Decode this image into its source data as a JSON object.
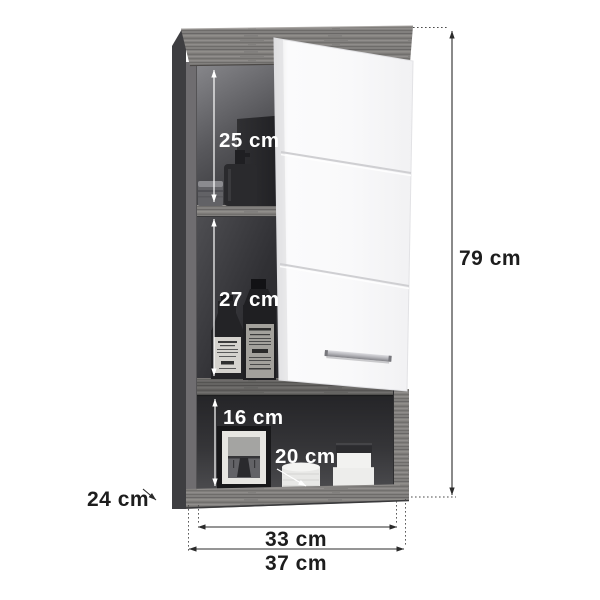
{
  "dimensions": {
    "total_height": {
      "value": 79,
      "unit": "cm",
      "label": "79 cm"
    },
    "total_width": {
      "value": 37,
      "unit": "cm",
      "label": "37 cm"
    },
    "inner_width": {
      "value": 33,
      "unit": "cm",
      "label": "33 cm"
    },
    "depth": {
      "value": 24,
      "unit": "cm",
      "label": "24 cm"
    },
    "top_compartment_height": {
      "value": 25,
      "unit": "cm",
      "label": "25 cm"
    },
    "middle_compartment_height": {
      "value": 27,
      "unit": "cm",
      "label": "27 cm"
    },
    "bottom_niche_height": {
      "value": 16,
      "unit": "cm",
      "label": "16 cm"
    },
    "bottom_niche_depth": {
      "value": 20,
      "unit": "cm",
      "label": "20 cm"
    }
  },
  "colors": {
    "background": "#ffffff",
    "wood_base": "#82807e",
    "wood_streak_dark": "#605e5d",
    "wood_streak_light": "#9b9896",
    "side_panel_dark": "#3e3e41",
    "side_panel_edge": "#6f6d70",
    "interior_dark": "#202023",
    "door_white": "#f9f9fa",
    "handle_metal": "#a9a9ae",
    "dimension_line_dark": "#2b2b2b",
    "dimension_line_light": "#ffffff",
    "label_dark": "#1d1d1d",
    "label_light": "#ffffff"
  }
}
